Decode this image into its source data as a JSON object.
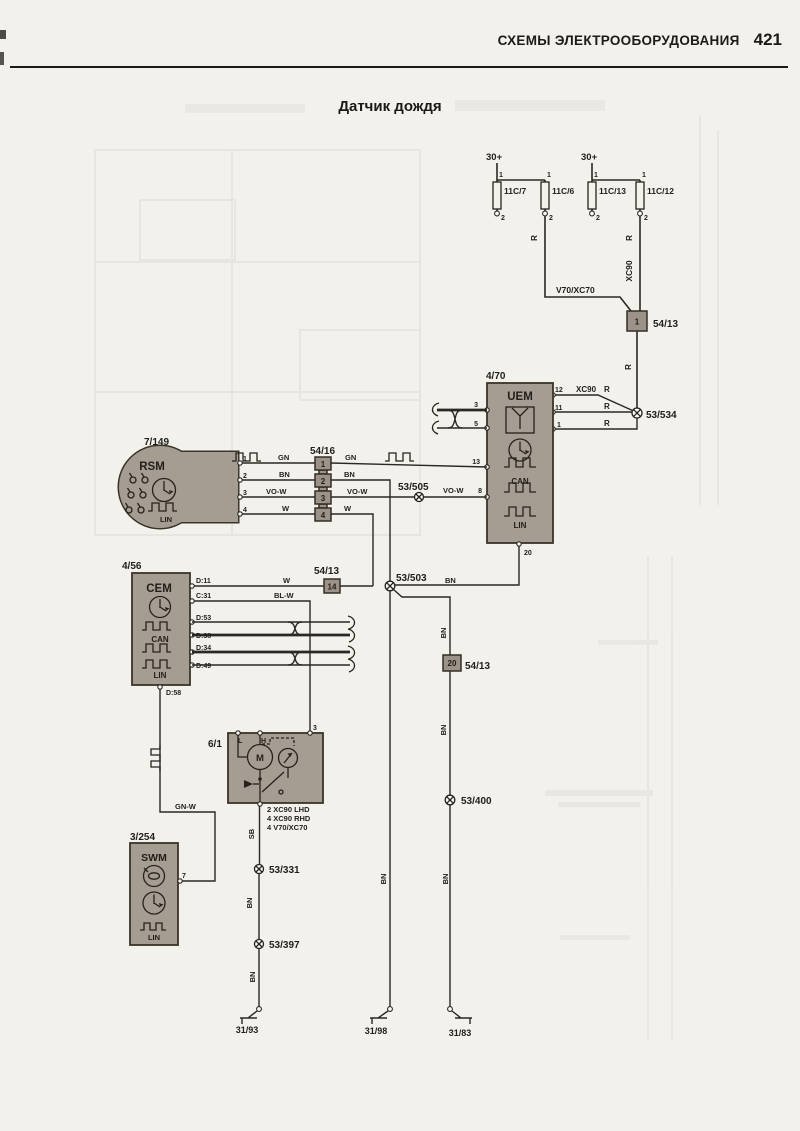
{
  "page": {
    "header_title": "СХЕМЫ ЭЛЕКТРООБОРУДОВАНИЯ",
    "page_number": "421",
    "diagram_title": "Датчик дождя"
  },
  "colors": {
    "page_bg": "#f3f1ec",
    "block_fill": "#a59c92",
    "block_stroke": "#3a342b",
    "wire": "#2b2823"
  },
  "supplies": [
    "30+",
    "30+"
  ],
  "fuses": [
    "11C/7",
    "11C/6",
    "11C/13",
    "11C/12"
  ],
  "components": {
    "rsm": {
      "id": "7/149",
      "name": "RSM"
    },
    "uem": {
      "id": "4/70",
      "name": "UEM"
    },
    "cem": {
      "id": "4/56",
      "name": "CEM"
    },
    "swm": {
      "id": "3/254",
      "name": "SWM"
    },
    "wiper_motor": {
      "id": "6/1",
      "motor_letter": "M",
      "variant_notes": [
        "2 XC90 LHD",
        "4 XC90 RHD",
        "4 V70/XC70"
      ]
    }
  },
  "bus": {
    "can": "CAN",
    "lin": "LIN"
  },
  "connectors": {
    "top": {
      "label": "54/13",
      "pin": "1"
    },
    "inline": {
      "label": "54/16",
      "pins": [
        "1",
        "2",
        "3",
        "4"
      ]
    },
    "mid": {
      "label": "54/13",
      "pin": "14"
    },
    "low": {
      "label": "54/13",
      "pin": "20"
    }
  },
  "splices": {
    "s534": "53/534",
    "s505": "53/505",
    "s503": "53/503",
    "s400": "53/400",
    "s331": "53/331",
    "s397": "53/397"
  },
  "grounds": [
    "31/93",
    "31/98",
    "31/83"
  ],
  "labels": [
    {
      "n": "wire-label-r-1",
      "t": "R",
      "x": 537,
      "y": 238,
      "r": 1,
      "s": 8
    },
    {
      "n": "wire-label-r-2",
      "t": "R",
      "x": 632,
      "y": 238,
      "r": 1,
      "s": 8
    },
    {
      "n": "wire-label-xc90-vertical",
      "t": "XC90",
      "x": 632,
      "y": 271,
      "r": 1,
      "s": 8.5
    },
    {
      "n": "wire-label-v70xc70",
      "t": "V70/XC70",
      "x": 556,
      "y": 293,
      "s": 8.5
    },
    {
      "n": "wire-label-r-3",
      "t": "R",
      "x": 631,
      "y": 367,
      "r": 1,
      "s": 8
    },
    {
      "n": "wire-label-xc90-horizontal",
      "t": "XC90",
      "x": 576,
      "y": 392,
      "s": 8
    },
    {
      "n": "wire-label-r-4",
      "t": "R",
      "x": 604,
      "y": 392,
      "s": 8
    },
    {
      "n": "wire-label-r-5",
      "t": "R",
      "x": 604,
      "y": 409,
      "s": 8
    },
    {
      "n": "wire-label-r-6",
      "t": "R",
      "x": 604,
      "y": 426,
      "s": 8
    },
    {
      "n": "wire-label-gn-1",
      "t": "GN",
      "x": 278,
      "y": 460,
      "s": 7.5
    },
    {
      "n": "wire-label-gn-2",
      "t": "GN",
      "x": 345,
      "y": 460,
      "s": 7.5
    },
    {
      "n": "wire-label-bn-1",
      "t": "BN",
      "x": 279,
      "y": 477,
      "s": 7.5
    },
    {
      "n": "wire-label-bn-2",
      "t": "BN",
      "x": 344,
      "y": 477,
      "s": 7.5
    },
    {
      "n": "wire-label-vow-1",
      "t": "VO-W",
      "x": 266,
      "y": 494,
      "s": 7.5
    },
    {
      "n": "wire-label-vow-2",
      "t": "VO-W",
      "x": 347,
      "y": 494,
      "s": 7.5
    },
    {
      "n": "wire-label-vow-3",
      "t": "VO-W",
      "x": 443,
      "y": 493,
      "s": 7.5
    },
    {
      "n": "wire-label-w-1",
      "t": "W",
      "x": 282,
      "y": 511,
      "s": 7.5
    },
    {
      "n": "wire-label-w-2",
      "t": "W",
      "x": 344,
      "y": 511,
      "s": 7.5
    },
    {
      "n": "wire-label-w-3",
      "t": "W",
      "x": 283,
      "y": 583,
      "s": 7.5
    },
    {
      "n": "wire-label-blw",
      "t": "BL-W",
      "x": 274,
      "y": 598,
      "s": 7.5
    },
    {
      "n": "wire-label-bn-3",
      "t": "BN",
      "x": 445,
      "y": 583,
      "s": 7.5
    },
    {
      "n": "wire-label-bn-4",
      "t": "BN",
      "x": 446,
      "y": 633,
      "r": 1,
      "s": 7.5
    },
    {
      "n": "wire-label-bn-5",
      "t": "BN",
      "x": 446,
      "y": 730,
      "r": 1,
      "s": 7.5
    },
    {
      "n": "wire-label-bn-6",
      "t": "BN",
      "x": 386,
      "y": 879,
      "r": 1,
      "s": 7.5
    },
    {
      "n": "wire-label-bn-7",
      "t": "BN",
      "x": 448,
      "y": 879,
      "r": 1,
      "s": 7.5
    },
    {
      "n": "wire-label-gnw",
      "t": "GN-W",
      "x": 175,
      "y": 809,
      "s": 7.5
    },
    {
      "n": "wire-label-sb",
      "t": "SB",
      "x": 254,
      "y": 834,
      "r": 1,
      "s": 7.5
    },
    {
      "n": "wire-label-bn-8",
      "t": "BN",
      "x": 252,
      "y": 903,
      "r": 1,
      "s": 7.5
    },
    {
      "n": "wire-label-bn-9",
      "t": "BN",
      "x": 255,
      "y": 977,
      "r": 1,
      "s": 7.5
    },
    {
      "n": "pin-label-f1-1",
      "t": "1",
      "x": 499,
      "y": 177,
      "s": 7
    },
    {
      "n": "pin-label-f2-1",
      "t": "1",
      "x": 547,
      "y": 177,
      "s": 7
    },
    {
      "n": "pin-label-f1-2",
      "t": "2",
      "x": 501,
      "y": 220,
      "s": 7
    },
    {
      "n": "pin-label-f2-2",
      "t": "2",
      "x": 549,
      "y": 220,
      "s": 7
    },
    {
      "n": "pin-label-f3-1",
      "t": "1",
      "x": 594,
      "y": 177,
      "s": 7
    },
    {
      "n": "pin-label-f4-1",
      "t": "1",
      "x": 642,
      "y": 177,
      "s": 7
    },
    {
      "n": "pin-label-f3-2",
      "t": "2",
      "x": 596,
      "y": 220,
      "s": 7
    },
    {
      "n": "pin-label-f4-2",
      "t": "2",
      "x": 644,
      "y": 220,
      "s": 7
    },
    {
      "n": "pin-label-uem-12",
      "t": "12",
      "x": 555,
      "y": 392,
      "s": 7
    },
    {
      "n": "pin-label-uem-11",
      "t": "11",
      "x": 555,
      "y": 410,
      "s": 7
    },
    {
      "n": "pin-label-uem-1",
      "t": "1",
      "x": 557,
      "y": 427,
      "s": 7
    },
    {
      "n": "pin-label-uem-3",
      "t": "3",
      "x": 478,
      "y": 407,
      "s": 7,
      "a": "end"
    },
    {
      "n": "pin-label-uem-5",
      "t": "5",
      "x": 478,
      "y": 426,
      "s": 7,
      "a": "end"
    },
    {
      "n": "pin-label-uem-13",
      "t": "13",
      "x": 480,
      "y": 464,
      "s": 7,
      "a": "end"
    },
    {
      "n": "pin-label-uem-8",
      "t": "8",
      "x": 482,
      "y": 493,
      "s": 7,
      "a": "end"
    },
    {
      "n": "pin-label-uem-20",
      "t": "20",
      "x": 524,
      "y": 555,
      "s": 7
    },
    {
      "n": "pin-label-rsm-1",
      "t": "1",
      "x": 243,
      "y": 461,
      "s": 7
    },
    {
      "n": "pin-label-rsm-2",
      "t": "2",
      "x": 243,
      "y": 478,
      "s": 7
    },
    {
      "n": "pin-label-rsm-3",
      "t": "3",
      "x": 243,
      "y": 495,
      "s": 7
    },
    {
      "n": "pin-label-rsm-4",
      "t": "4",
      "x": 243,
      "y": 512,
      "s": 7
    },
    {
      "n": "pin-label-cem-d11",
      "t": "D:11",
      "x": 196,
      "y": 583,
      "s": 7
    },
    {
      "n": "pin-label-cem-c31",
      "t": "C:31",
      "x": 196,
      "y": 598,
      "s": 7
    },
    {
      "n": "pin-label-cem-d53",
      "t": "D:53",
      "x": 196,
      "y": 620,
      "s": 7
    },
    {
      "n": "pin-label-cem-d38",
      "t": "D:38",
      "x": 196,
      "y": 638,
      "s": 7
    },
    {
      "n": "pin-label-cem-d34",
      "t": "D:34",
      "x": 196,
      "y": 650,
      "s": 7
    },
    {
      "n": "pin-label-cem-d49",
      "t": "D:49",
      "x": 196,
      "y": 668,
      "s": 7
    },
    {
      "n": "pin-label-cem-d58",
      "t": "D:58",
      "x": 166,
      "y": 695,
      "s": 7
    },
    {
      "n": "pin-label-motor-l",
      "t": "L",
      "x": 238,
      "y": 743,
      "s": 7
    },
    {
      "n": "pin-label-motor-h",
      "t": "H",
      "x": 261,
      "y": 743,
      "s": 7
    },
    {
      "n": "pin-label-motor-3",
      "t": "3",
      "x": 313,
      "y": 730,
      "s": 7
    },
    {
      "n": "pin-label-swm-7",
      "t": "7",
      "x": 182,
      "y": 878,
      "s": 7
    }
  ]
}
